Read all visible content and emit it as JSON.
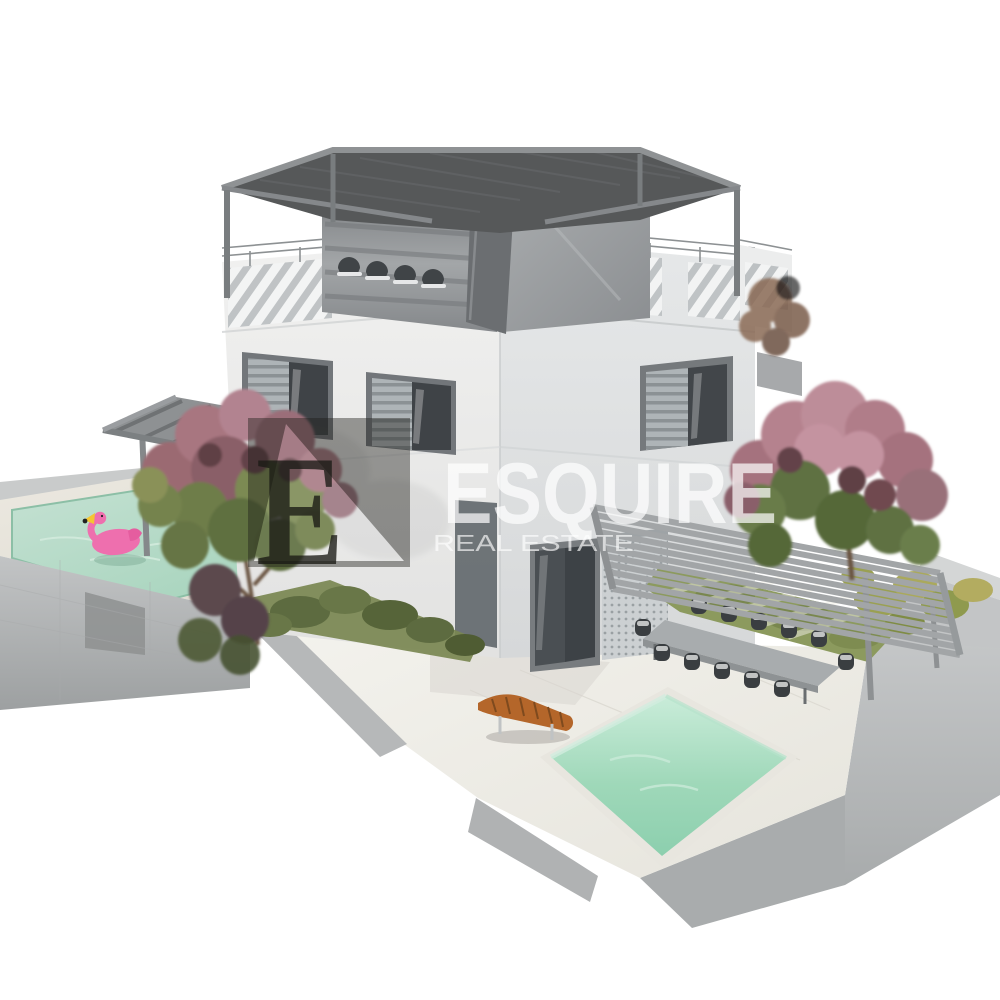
{
  "watermark": {
    "brand": "ESQUIRE",
    "tagline": "REAL ESTATE",
    "monogram": "E"
  },
  "scene": {
    "type": "3d-architectural-render",
    "subject": "Modern three-storey white villa with rooftop pergolas, two swimming pools, pool decks, outdoor dining pergola and flowering trees on a concrete platform",
    "objects": [
      "villa building",
      "rooftop pergola",
      "roof terrace loungers",
      "penthouse volume",
      "parapet railing with louver panels",
      "louvered window shutters",
      "sliding glass doors",
      "perforated screen",
      "raised left pool deck",
      "left swimming pool",
      "pink flamingo float",
      "deck pergola",
      "sun loungers",
      "ground marble terrace",
      "right swimming pool",
      "outdoor dining table",
      "dining chairs",
      "dining pergola",
      "wooden sun lounger",
      "flowering oleander trees",
      "garden shrubs",
      "concrete platform"
    ]
  },
  "colors": {
    "background": "#ffffff",
    "wall_light": "#ececeb",
    "wall_shaded": "#dfe1e2",
    "roof_dark": "#565859",
    "pergola_beam": "#8a8d8f",
    "penthouse_clad": "#8e9194",
    "concrete": "#b3b5b6",
    "deck_travertine": "#e9e6de",
    "marble_terrace": "#f0efe9",
    "pool_water_left": "#b5d9c6",
    "pool_water_right": "#9fd8b9",
    "flamingo_pink": "#ee6fae",
    "wood_lounger": "#b4662a",
    "foliage_green": "#5e7043",
    "blossom_pink": "#b07d89",
    "grass": "#8c9a5e",
    "watermark_overlay": "rgba(28,28,24,0.42)",
    "watermark_text": "rgba(255,255,255,0.70)"
  }
}
